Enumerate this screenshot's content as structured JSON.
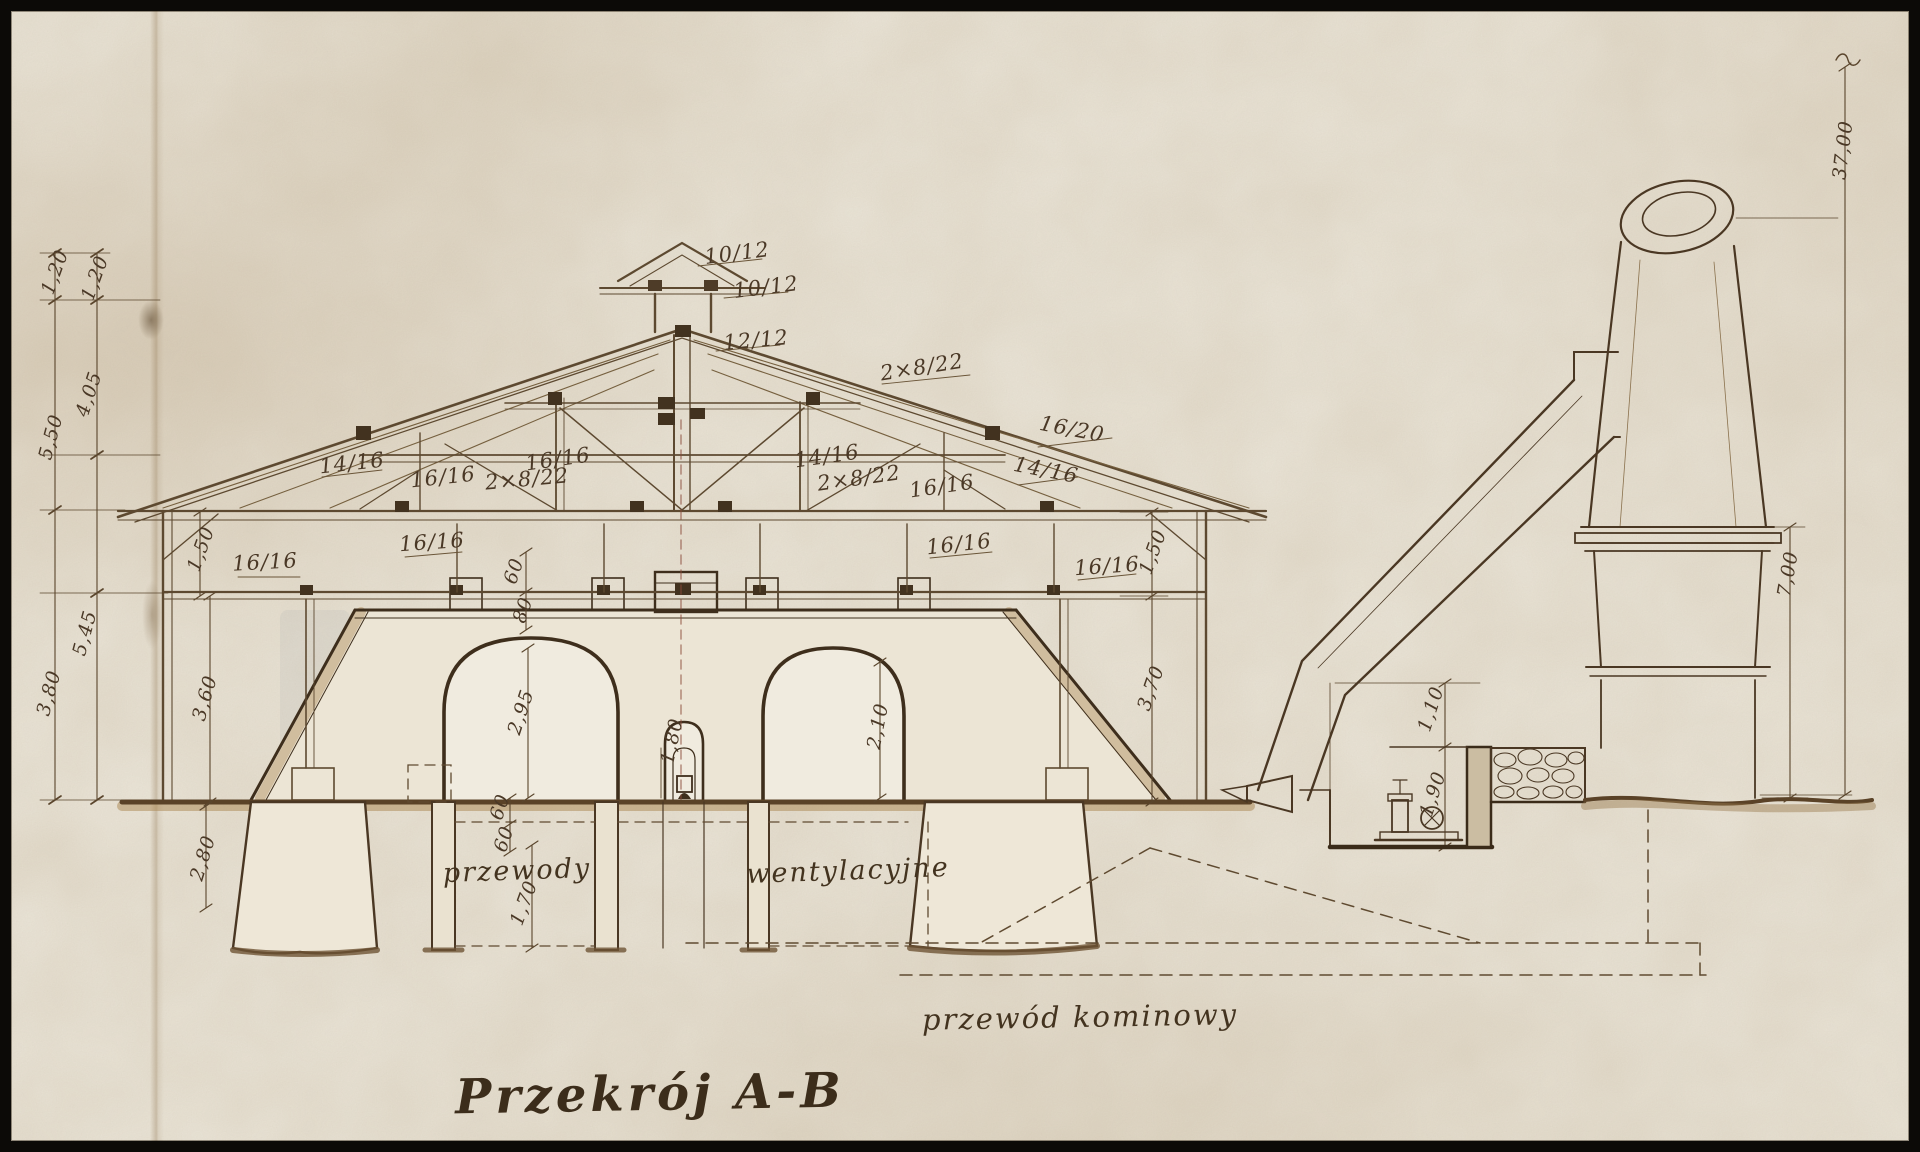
{
  "drawing": {
    "title": "Przekrój A-B",
    "annotations": {
      "duct_label_left": "przewody",
      "duct_label_right": "wentylacyjne",
      "chimney_flue_label": "przewód kominowy"
    },
    "timber_labels": [
      {
        "text": "10/12"
      },
      {
        "text": "10/12"
      },
      {
        "text": "12/12"
      },
      {
        "text": "2×8/22"
      },
      {
        "text": "16/20"
      },
      {
        "text": "14/16"
      },
      {
        "text": "16/16"
      },
      {
        "text": "2×8/22"
      },
      {
        "text": "16/16"
      },
      {
        "text": "14/16"
      },
      {
        "text": "2×8/22"
      },
      {
        "text": "16/16"
      },
      {
        "text": "14/16"
      },
      {
        "text": "16/16"
      },
      {
        "text": "16/16"
      },
      {
        "text": "16/16"
      },
      {
        "text": "16/16"
      }
    ],
    "dimension_labels": [
      {
        "text": "1,20"
      },
      {
        "text": "1,20"
      },
      {
        "text": "5,50"
      },
      {
        "text": "4,05"
      },
      {
        "text": "5,45"
      },
      {
        "text": "3,80"
      },
      {
        "text": "2,80"
      },
      {
        "text": "1,50"
      },
      {
        "text": "3,60"
      },
      {
        "text": "2,95"
      },
      {
        "text": "1,80"
      },
      {
        "text": "2,10"
      },
      {
        "text": "60"
      },
      {
        "text": "80"
      },
      {
        "text": "60"
      },
      {
        "text": "60"
      },
      {
        "text": "1,70"
      },
      {
        "text": "1,50"
      },
      {
        "text": "3,70"
      },
      {
        "text": "1,10"
      },
      {
        "text": "1,90"
      },
      {
        "text": "7,00"
      },
      {
        "text": "37,00"
      }
    ],
    "colors": {
      "paper": "#ece7db",
      "ink": "#4a3a28",
      "heavy_line": "#3e2e1c",
      "wash": "#a9854f",
      "ground_line": "#5a4227"
    }
  }
}
